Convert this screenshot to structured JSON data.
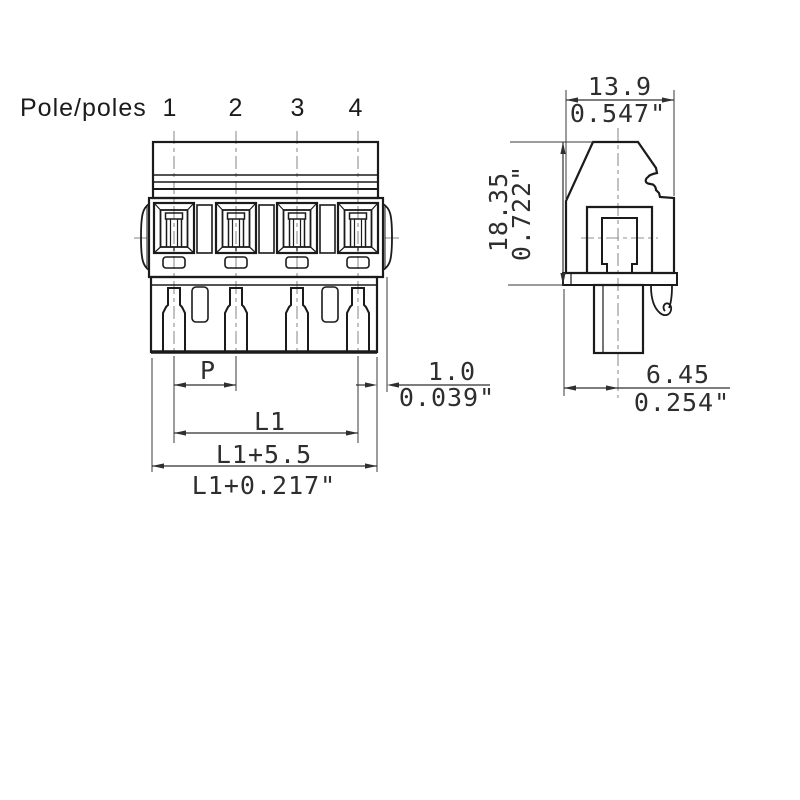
{
  "drawing": {
    "pole_label": "Pole/poles",
    "pole_numbers": [
      "1",
      "2",
      "3",
      "4"
    ],
    "front_dims": {
      "pitch": "P",
      "length": "L1",
      "overall_mm": "L1+5.5",
      "overall_in": "L1+0.217\"",
      "offset_mm": "1.0",
      "offset_in": "0.039\""
    },
    "side_dims": {
      "width_mm": "13.9",
      "width_in": "0.547\"",
      "height_mm": "18.35",
      "height_in": "0.722\"",
      "pin_offset_mm": "6.45",
      "pin_offset_in": "0.254\""
    }
  },
  "colors": {
    "outline": "#1b1b1b",
    "dimension": "#2f2f2f",
    "centerline": "#909090",
    "background": "#ffffff"
  }
}
